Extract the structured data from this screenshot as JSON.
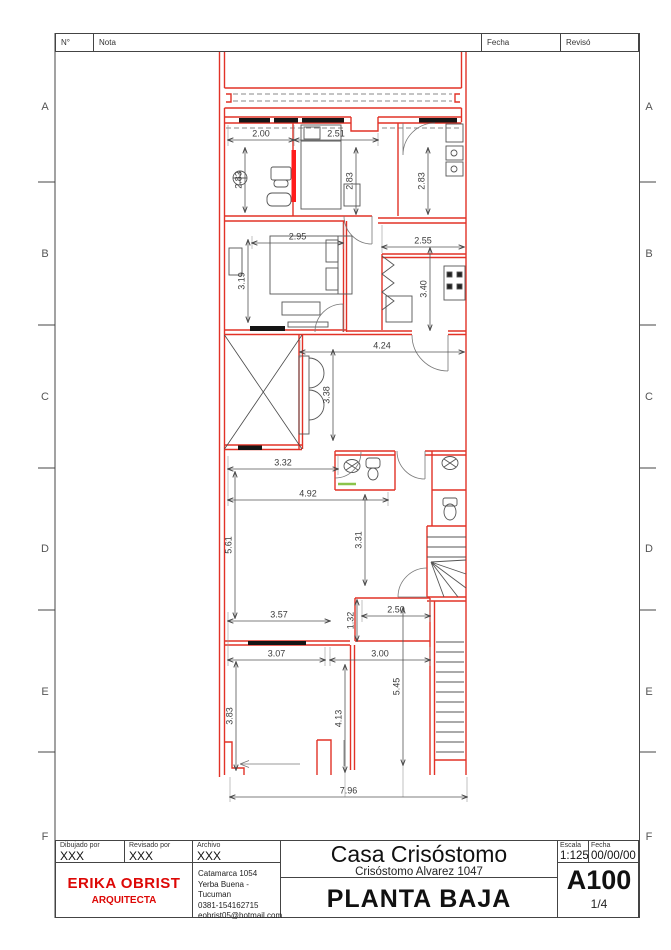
{
  "sheet": {
    "header": {
      "col_no": "N°",
      "col_nota": "Nota",
      "col_fecha": "Fecha",
      "col_reviso": "Revisó"
    },
    "grid_rows": [
      {
        "label": "A",
        "y": 108
      },
      {
        "label": "B",
        "y": 255
      },
      {
        "label": "C",
        "y": 398
      },
      {
        "label": "D",
        "y": 550
      },
      {
        "label": "E",
        "y": 693
      },
      {
        "label": "F",
        "y": 838
      }
    ],
    "colors": {
      "wall_red": "#e23227",
      "highlight_red": "#ff1c1c",
      "brand_red": "#dd0806",
      "line_gray": "#666666",
      "dim_text": "#3a3a3a"
    }
  },
  "plan": {
    "dimensions": [
      {
        "v": "2.00",
        "o": "h",
        "x1": 228,
        "x2": 294,
        "y": 140
      },
      {
        "v": "2.51",
        "o": "h",
        "x1": 294,
        "x2": 378,
        "y": 140
      },
      {
        "v": "2.95",
        "o": "h",
        "x1": 252,
        "x2": 343,
        "y": 243
      },
      {
        "v": "2.55",
        "o": "h",
        "x1": 382,
        "x2": 464,
        "y": 247
      },
      {
        "v": "4.24",
        "o": "h",
        "x1": 300,
        "x2": 464,
        "y": 352
      },
      {
        "v": "3.32",
        "o": "h",
        "x1": 228,
        "x2": 338,
        "y": 469
      },
      {
        "v": "4.92",
        "o": "h",
        "x1": 228,
        "x2": 388,
        "y": 500
      },
      {
        "v": "2.50",
        "o": "h",
        "x1": 362,
        "x2": 430,
        "y": 616
      },
      {
        "v": "3.57",
        "o": "h",
        "x1": 228,
        "x2": 330,
        "y": 621
      },
      {
        "v": "3.07",
        "o": "h",
        "x1": 228,
        "x2": 325,
        "y": 660
      },
      {
        "v": "3.00",
        "o": "h",
        "x1": 330,
        "x2": 430,
        "y": 660
      },
      {
        "v": "7.96",
        "o": "h",
        "x1": 230,
        "x2": 467,
        "y": 797
      },
      {
        "v": "2.83",
        "o": "v",
        "x": 245,
        "y1": 148,
        "y2": 212
      },
      {
        "v": "2.83",
        "o": "v",
        "x": 356,
        "y1": 148,
        "y2": 214
      },
      {
        "v": "2.83",
        "o": "v",
        "x": 428,
        "y1": 148,
        "y2": 214
      },
      {
        "v": "3.19",
        "o": "v",
        "x": 248,
        "y1": 240,
        "y2": 322
      },
      {
        "v": "3.40",
        "o": "v",
        "x": 430,
        "y1": 248,
        "y2": 330
      },
      {
        "v": "3.38",
        "o": "v",
        "x": 333,
        "y1": 350,
        "y2": 440
      },
      {
        "v": "5.61",
        "o": "v",
        "x": 235,
        "y1": 472,
        "y2": 618
      },
      {
        "v": "3.31",
        "o": "v",
        "x": 365,
        "y1": 495,
        "y2": 585
      },
      {
        "v": "1.32",
        "o": "v",
        "x": 357,
        "y1": 600,
        "y2": 641
      },
      {
        "v": "3.83",
        "o": "v",
        "x": 236,
        "y1": 662,
        "y2": 770
      },
      {
        "v": "4.13",
        "o": "v",
        "x": 345,
        "y1": 665,
        "y2": 772
      },
      {
        "v": "5.45",
        "o": "v",
        "x": 403,
        "y1": 608,
        "y2": 765
      }
    ]
  },
  "title_block": {
    "dibujado": {
      "label": "Dibujado por",
      "value": "XXX"
    },
    "revisado": {
      "label": "Revisado por",
      "value": "XXX"
    },
    "archivo": {
      "label": "Archivo",
      "value": "XXX"
    },
    "firm": {
      "name": "ERIKA OBRIST",
      "title": "ARQUITECTA",
      "address_lines": [
        "Catamarca 1054",
        "Yerba Buena - Tucuman",
        "0381-154162715",
        "eobrist05@hotmail.com"
      ]
    },
    "project": {
      "title": "Casa Crisóstomo",
      "address": "Crisóstomo Alvarez 1047",
      "sheet_title": "PLANTA BAJA"
    },
    "escala": {
      "label": "Escala",
      "value": "1:125"
    },
    "fecha": {
      "label": "Fecha",
      "value": "00/00/00"
    },
    "sheet_number": "A100",
    "page": "1/4"
  }
}
